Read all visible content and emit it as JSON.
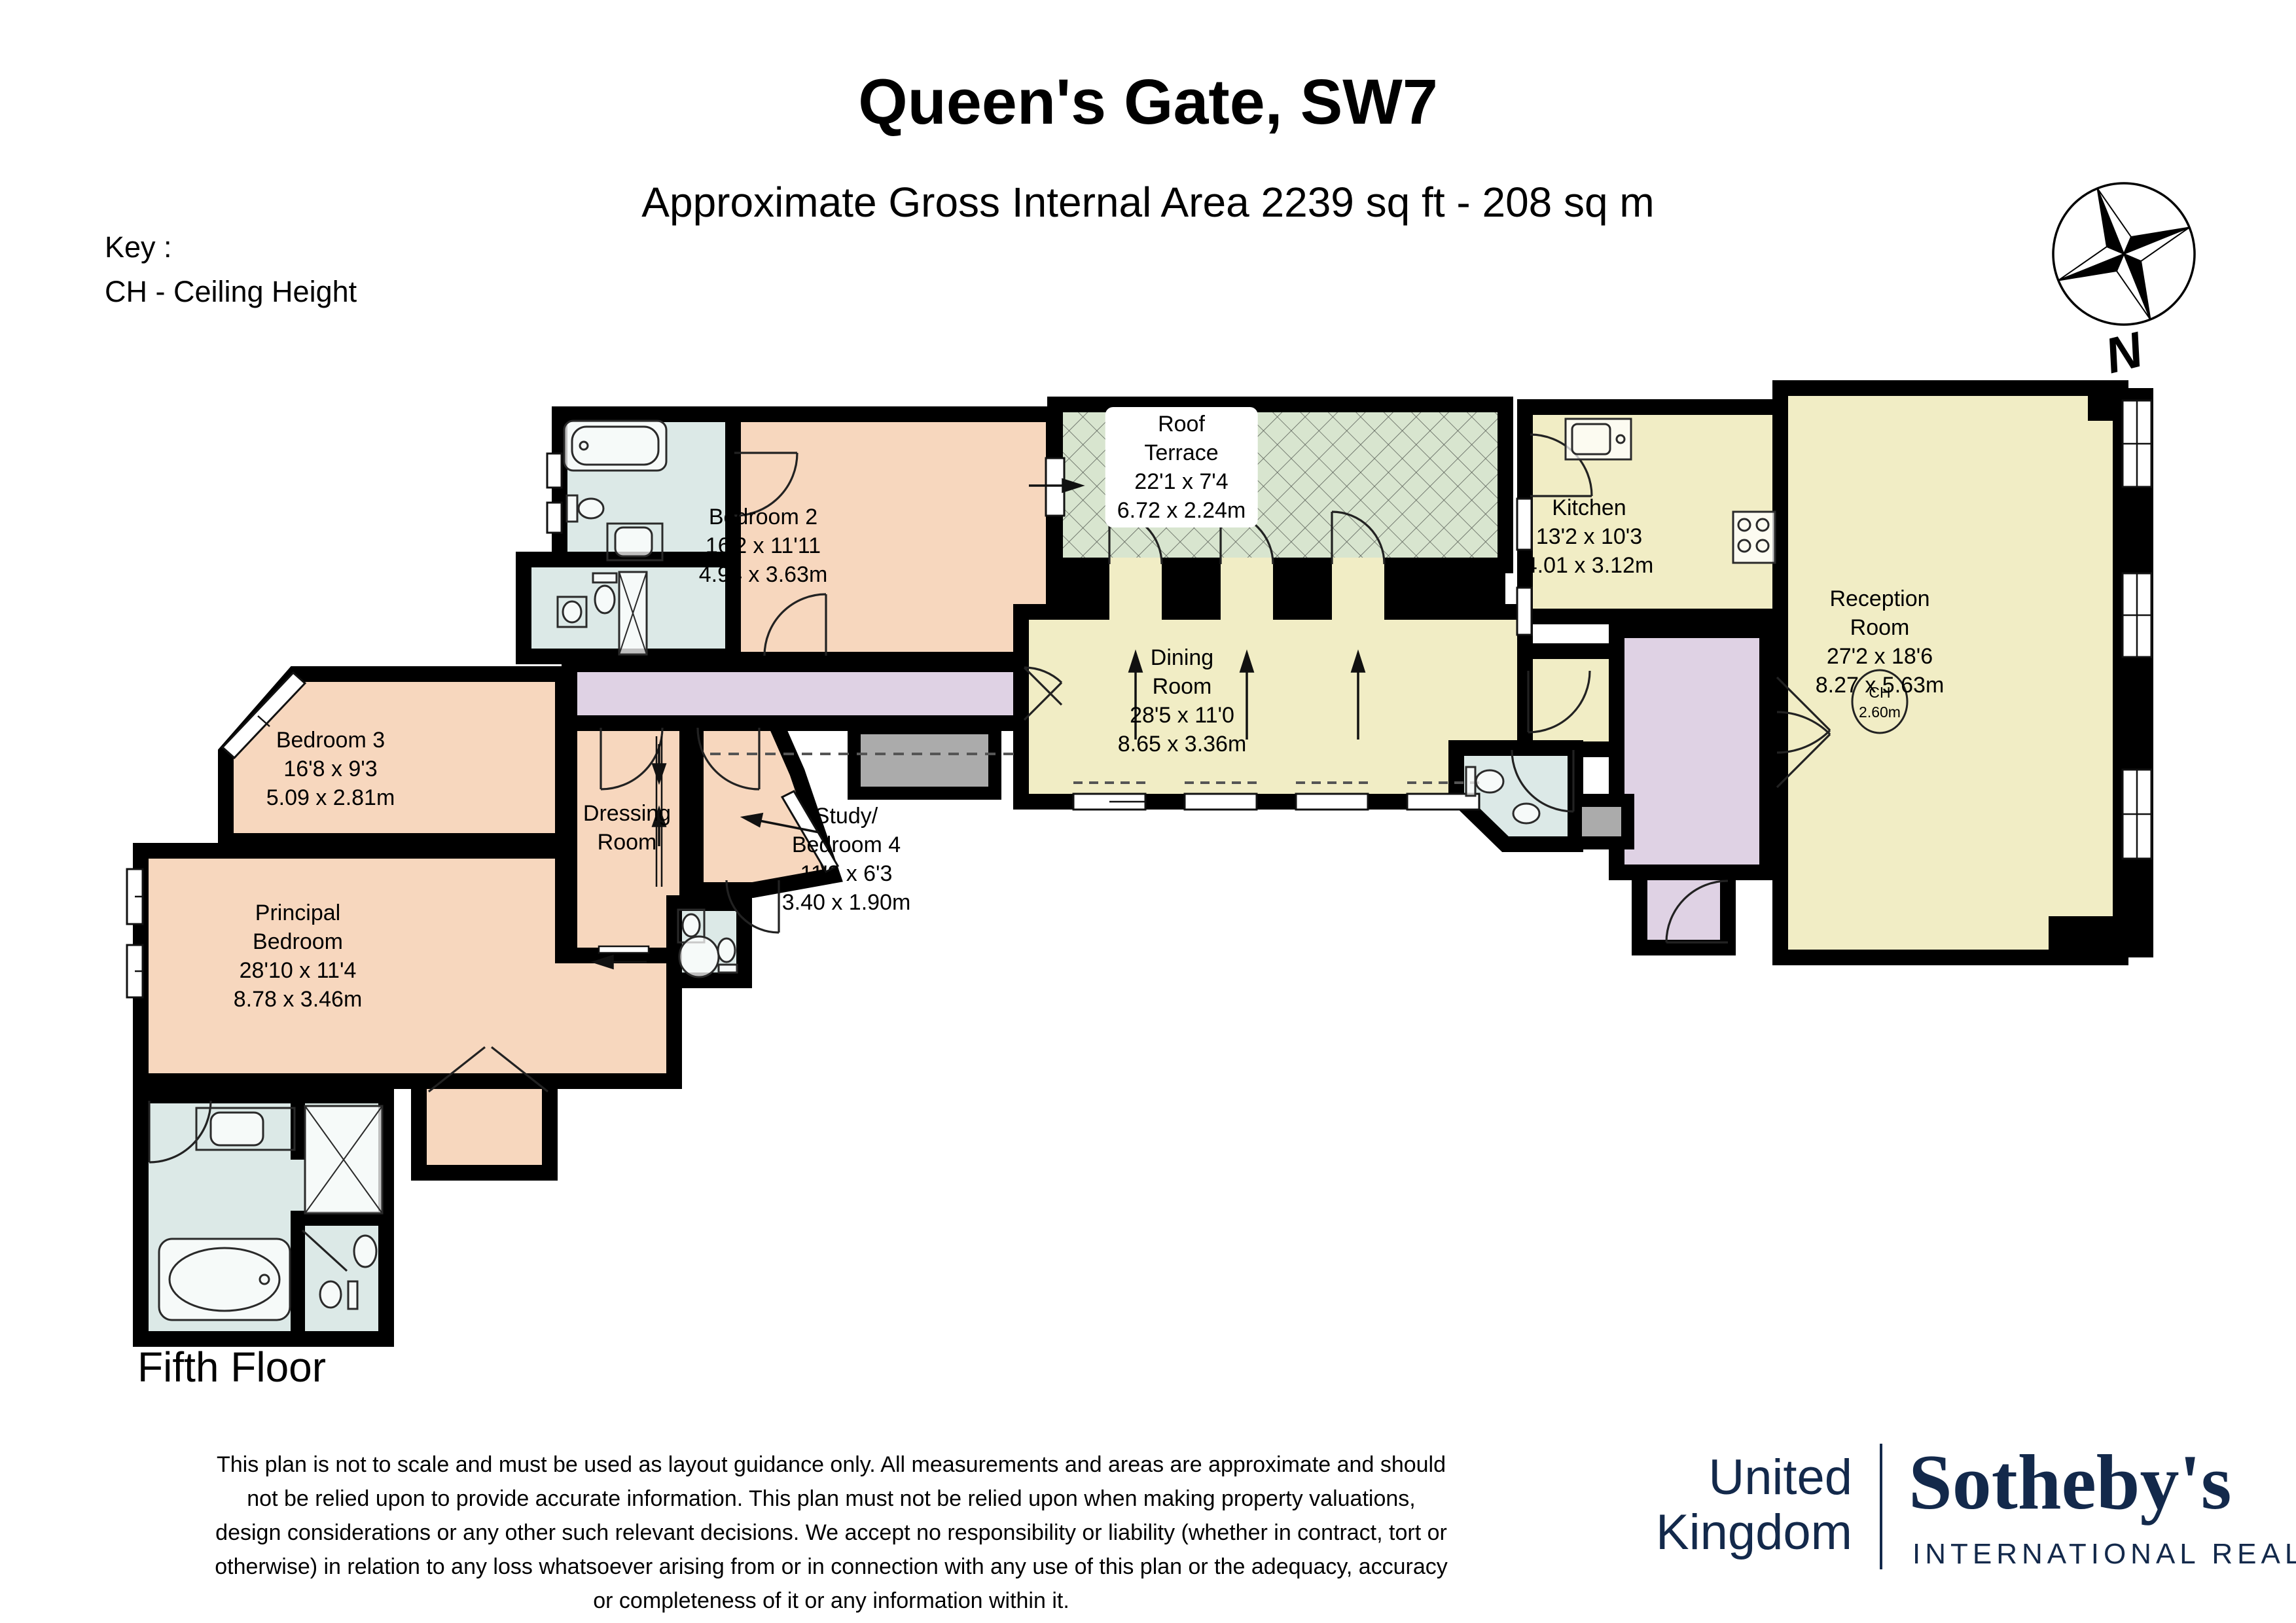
{
  "header": {
    "title": "Queen's Gate, SW7",
    "subtitle": "Approximate Gross Internal Area 2239 sq ft - 208 sq m"
  },
  "key": {
    "heading": "Key :",
    "ceiling_height": "CH - Ceiling Height"
  },
  "compass": {
    "north": "N"
  },
  "floor_label": "Fifth Floor",
  "rooms": {
    "roof_terrace": {
      "lines": [
        "Roof",
        "Terrace",
        "22'1 x 7'4",
        "6.72 x 2.24m"
      ]
    },
    "bedroom_2": {
      "lines": [
        "Bedroom 2",
        "16'2 x 11'11",
        "4.94 x 3.63m"
      ]
    },
    "kitchen": {
      "lines": [
        "Kitchen",
        "13'2 x 10'3",
        "4.01 x 3.12m"
      ]
    },
    "reception_room": {
      "lines": [
        "Reception",
        "Room",
        "27'2 x 18'6",
        "8.27 x 5.63m"
      ],
      "ch": [
        "CH",
        "2.60m"
      ]
    },
    "dining_room": {
      "lines": [
        "Dining",
        "Room",
        "28'5 x 11'0",
        "8.65 x 3.36m"
      ]
    },
    "bedroom_3": {
      "lines": [
        "Bedroom 3",
        "16'8 x 9'3",
        "5.09 x 2.81m"
      ]
    },
    "dressing_room": {
      "lines": [
        "Dressing",
        "Room"
      ]
    },
    "study_bedroom_4": {
      "lines": [
        "Study/",
        "Bedroom 4",
        "11'2 x 6'3",
        "3.40 x 1.90m"
      ]
    },
    "principal_bedroom": {
      "lines": [
        "Principal",
        "Bedroom",
        "28'10 x 11'4",
        "8.78 x 3.46m"
      ]
    }
  },
  "disclaimer": {
    "lines": [
      "This plan is not to scale and must be used as layout guidance only. All measurements and areas are approximate and should",
      "not be relied upon to provide accurate information. This plan must not be relied upon when making property valuations,",
      "design considerations or any other such relevant decisions. We accept no responsibility or liability (whether in contract, tort or",
      "otherwise) in relation to any loss whatsoever arising from or in connection with any use of this plan or the adequacy, accuracy",
      "or completeness of it or any information within it."
    ]
  },
  "branding": {
    "country_lines": [
      "United",
      "Kingdom"
    ],
    "brand": "Sotheby's",
    "brand_subtitle": "INTERNATIONAL REALTY"
  },
  "colors": {
    "bedroom": "#F7D7BE",
    "bathroom": "#DCE9E7",
    "living": "#F1EDC5",
    "hall": "#DFD2E4",
    "terrace": "#D8E5CF",
    "reduced_headroom": "#ABABAB",
    "wall": "#000000",
    "brand_navy": "#13294B"
  }
}
